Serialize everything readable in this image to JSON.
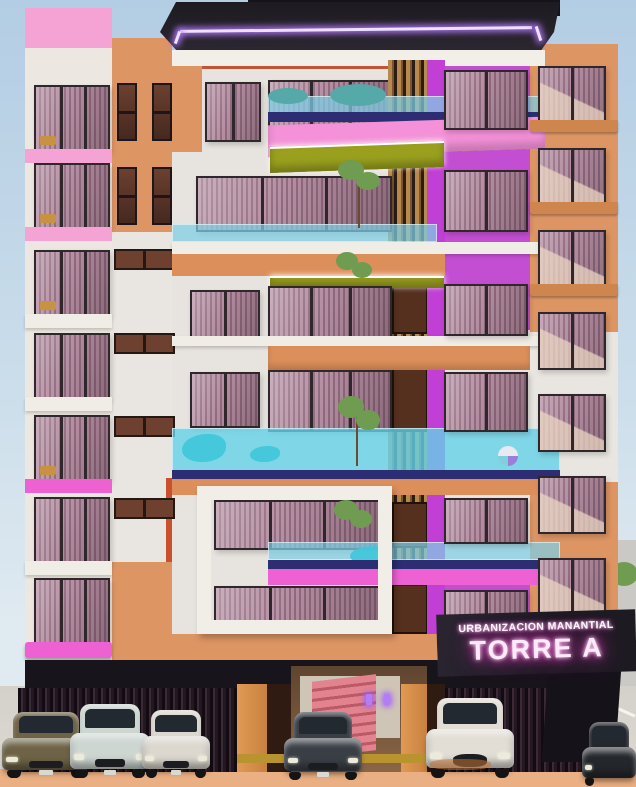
{
  "sign": {
    "line1": "URBANIZACION MANANTIAL",
    "line2": "TORRE A"
  },
  "scene": {
    "subject": "apartment tower facade render",
    "cars_visible": 6
  },
  "cars": [
    {
      "type": "sedan",
      "color_name": "olive-brown"
    },
    {
      "type": "sedan",
      "color_name": "silver"
    },
    {
      "type": "sedan",
      "color_name": "white"
    },
    {
      "type": "sedan",
      "color_name": "dark-grey"
    },
    {
      "type": "suv",
      "color_name": "white"
    },
    {
      "type": "sedan",
      "color_name": "black (partial)"
    }
  ],
  "colors": {
    "skyTop": "#b3cde4",
    "skyBot": "#e0eaf1",
    "cream": "#ece7e0",
    "slab": "#f0ece6",
    "fascia": "#f2efe9",
    "pink": "#f4a3d4",
    "pinkBalcony": "#f491d8",
    "hotPink": "#ee61d2",
    "orange": "#dd9564",
    "orangeBand": "#dc8f5a",
    "orangeDeep": "#c8813f",
    "redAccent": "#c05535",
    "curtain": "#b48da1",
    "curtainDark": "#8f6a7e",
    "frame": "#30272c",
    "magenta": "#c44ed2",
    "magentaStrip": "#c13fd4",
    "olive": "#9aa01e",
    "cyan": "#7ed0e6",
    "water": "#3fc6da",
    "navy": "#2d2d74",
    "wood": "#b8894e",
    "woodGap": "#2a1d14",
    "door": "#56301f",
    "canopyA": "#1d1a20",
    "canopyB": "#2c2731",
    "neon": "#eee0ff",
    "neonGlow": "#b57bff",
    "signBg": "#1e1a22",
    "signGlow": "#ff3fd4",
    "pavement": "#d4d0ca",
    "curb": "#eaaf83",
    "lineWhite": "#f6f4ef",
    "sideWall": "#48474b",
    "farStreet": "#cbc9c5",
    "groundDark": "#18141b",
    "lobbyWall": "#8a6645",
    "lobbyBack": "#cfc5b7",
    "stair": "#e2838f",
    "stairDark": "#b95a66",
    "pillar": "#2f1b12",
    "yellowCurb": "#b8932f",
    "green": "#6f9c50",
    "teal": "#55a9a9",
    "car1": "#6e6347",
    "car2": "#ced6d2",
    "car3": "#dcd8d0",
    "car4": "#3a3f46",
    "car5": "#e2ded6",
    "car6": "#24272c",
    "tire": "#141414",
    "carGlass": "#222931"
  }
}
